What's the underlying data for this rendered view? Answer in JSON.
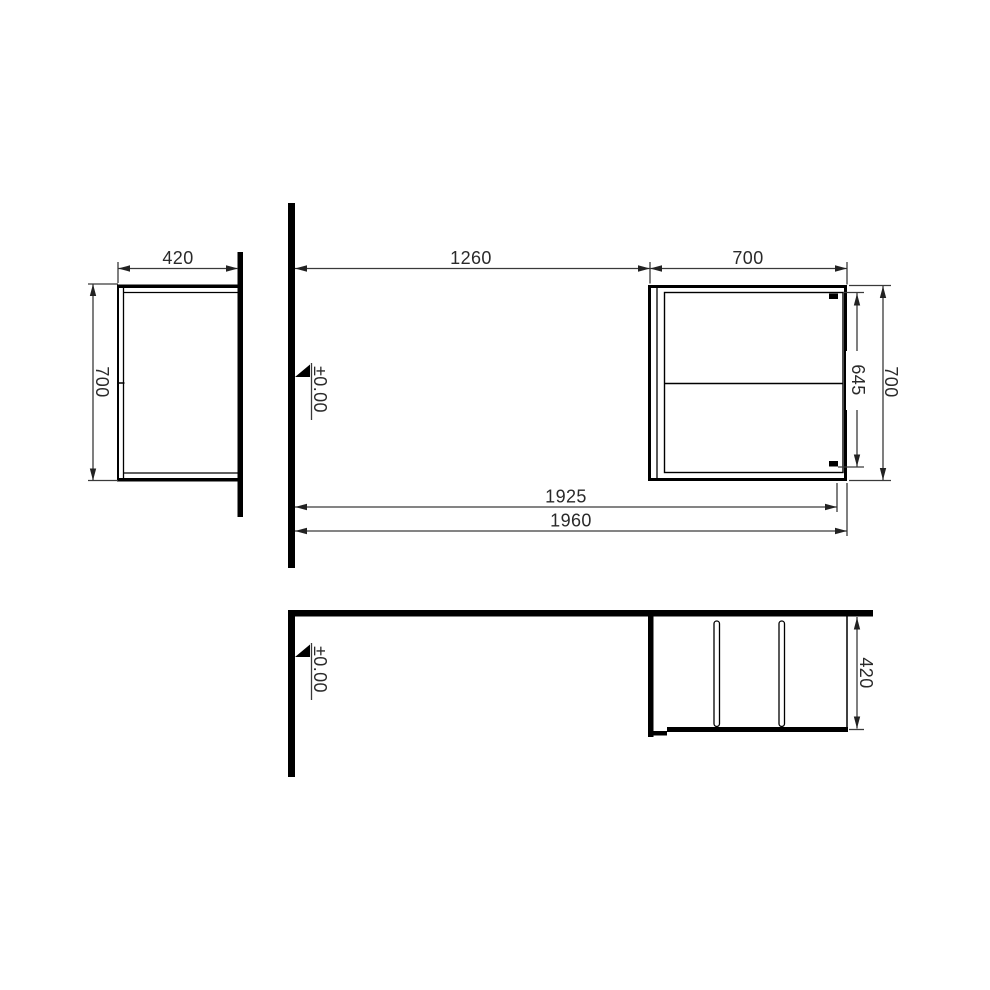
{
  "drawing": {
    "dim_labels": {
      "side_depth": "420",
      "side_height": "700",
      "wall_to_unit": "1260",
      "unit_width": "700",
      "unit_inner_height": "645",
      "unit_height": "700",
      "wall_to_front_inner": "1925",
      "overall_length": "1960",
      "plan_depth": "420"
    },
    "level_labels": {
      "elevation": "±0.00",
      "plan": "±0.00"
    },
    "colors": {
      "object_line": "#000000",
      "dimension_line": "#3a3a3a",
      "text": "#2a2a2a",
      "background": "#ffffff"
    }
  }
}
